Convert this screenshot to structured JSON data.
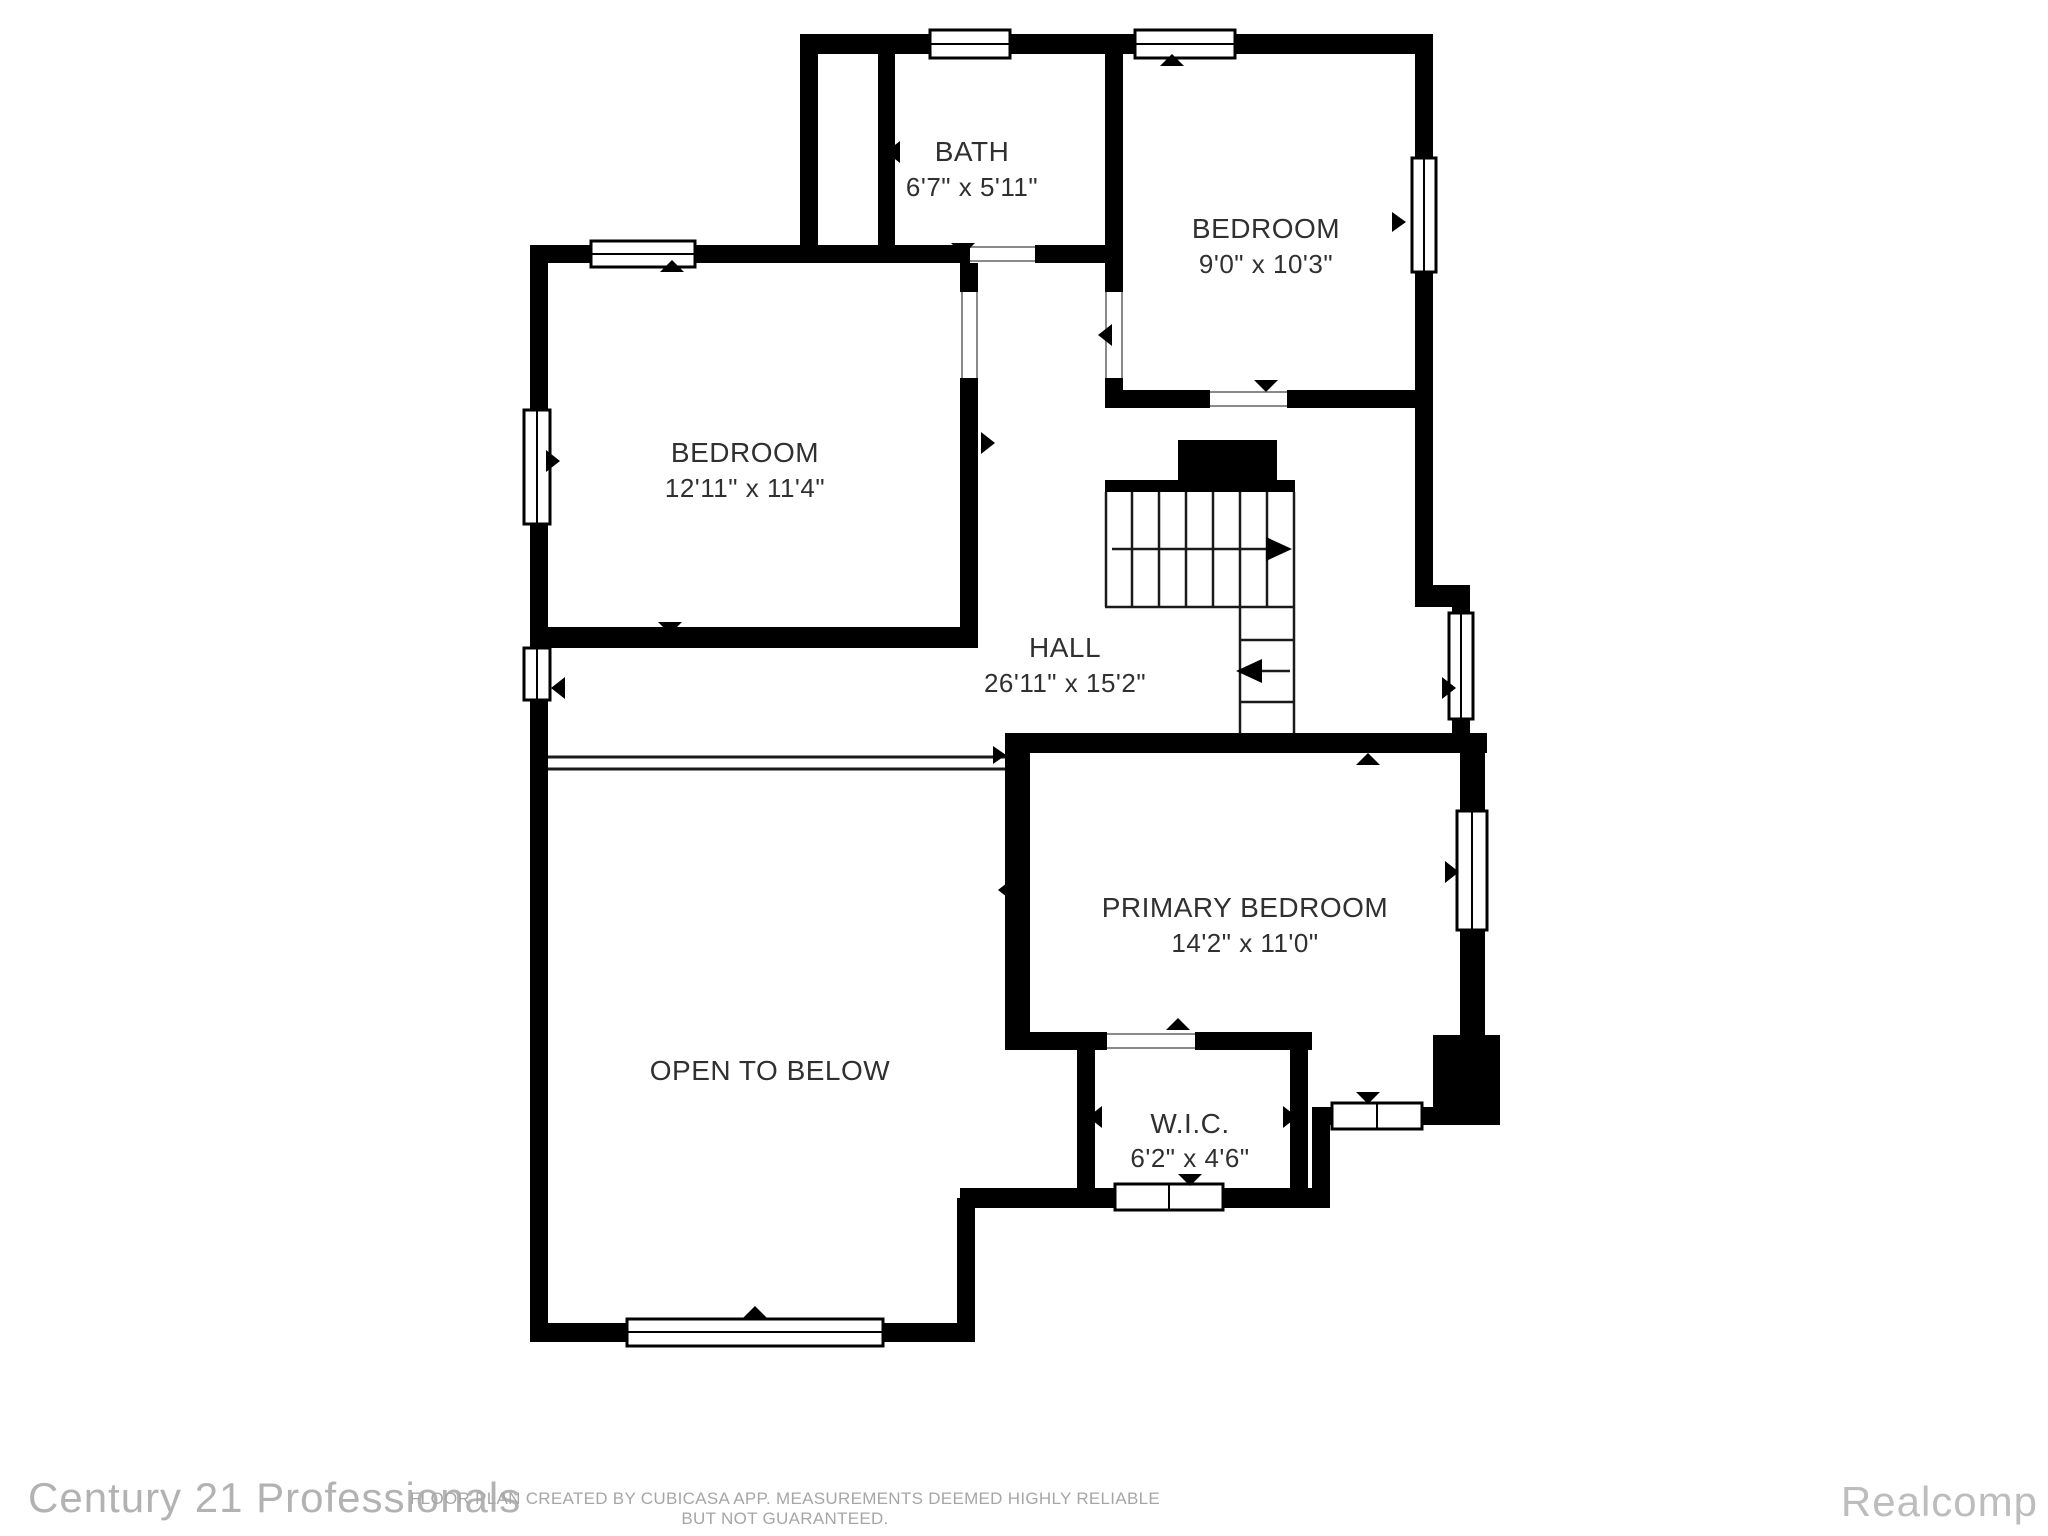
{
  "page": {
    "background": "#ffffff"
  },
  "floor_plan": {
    "wall_color": "#000000",
    "label_color": "#303030",
    "source_app": "CubiCasa",
    "rooms": [
      {
        "id": "bath",
        "name": "BATH",
        "dims": "6'7\" x 5'11\""
      },
      {
        "id": "bedroom-top",
        "name": "BEDROOM",
        "dims": "9'0\" x 10'3\""
      },
      {
        "id": "bedroom-left",
        "name": "BEDROOM",
        "dims": "12'11\" x 11'4\""
      },
      {
        "id": "hall",
        "name": "HALL",
        "dims": "26'11\" x 15'2\""
      },
      {
        "id": "primary-bedroom",
        "name": "PRIMARY BEDROOM",
        "dims": "14'2\" x 11'0\""
      },
      {
        "id": "wic",
        "name": "W.I.C.",
        "dims": "6'2\" x 4'6\""
      },
      {
        "id": "open-to-below",
        "name": "OPEN TO BELOW",
        "dims": ""
      }
    ]
  },
  "footer": {
    "left_brand": "Century 21 Professionals",
    "disclaimer": "FLOOR PLAN CREATED BY CUBICASA APP. MEASUREMENTS DEEMED HIGHLY RELIABLE BUT NOT GUARANTEED.",
    "right_brand": "Realcomp"
  }
}
